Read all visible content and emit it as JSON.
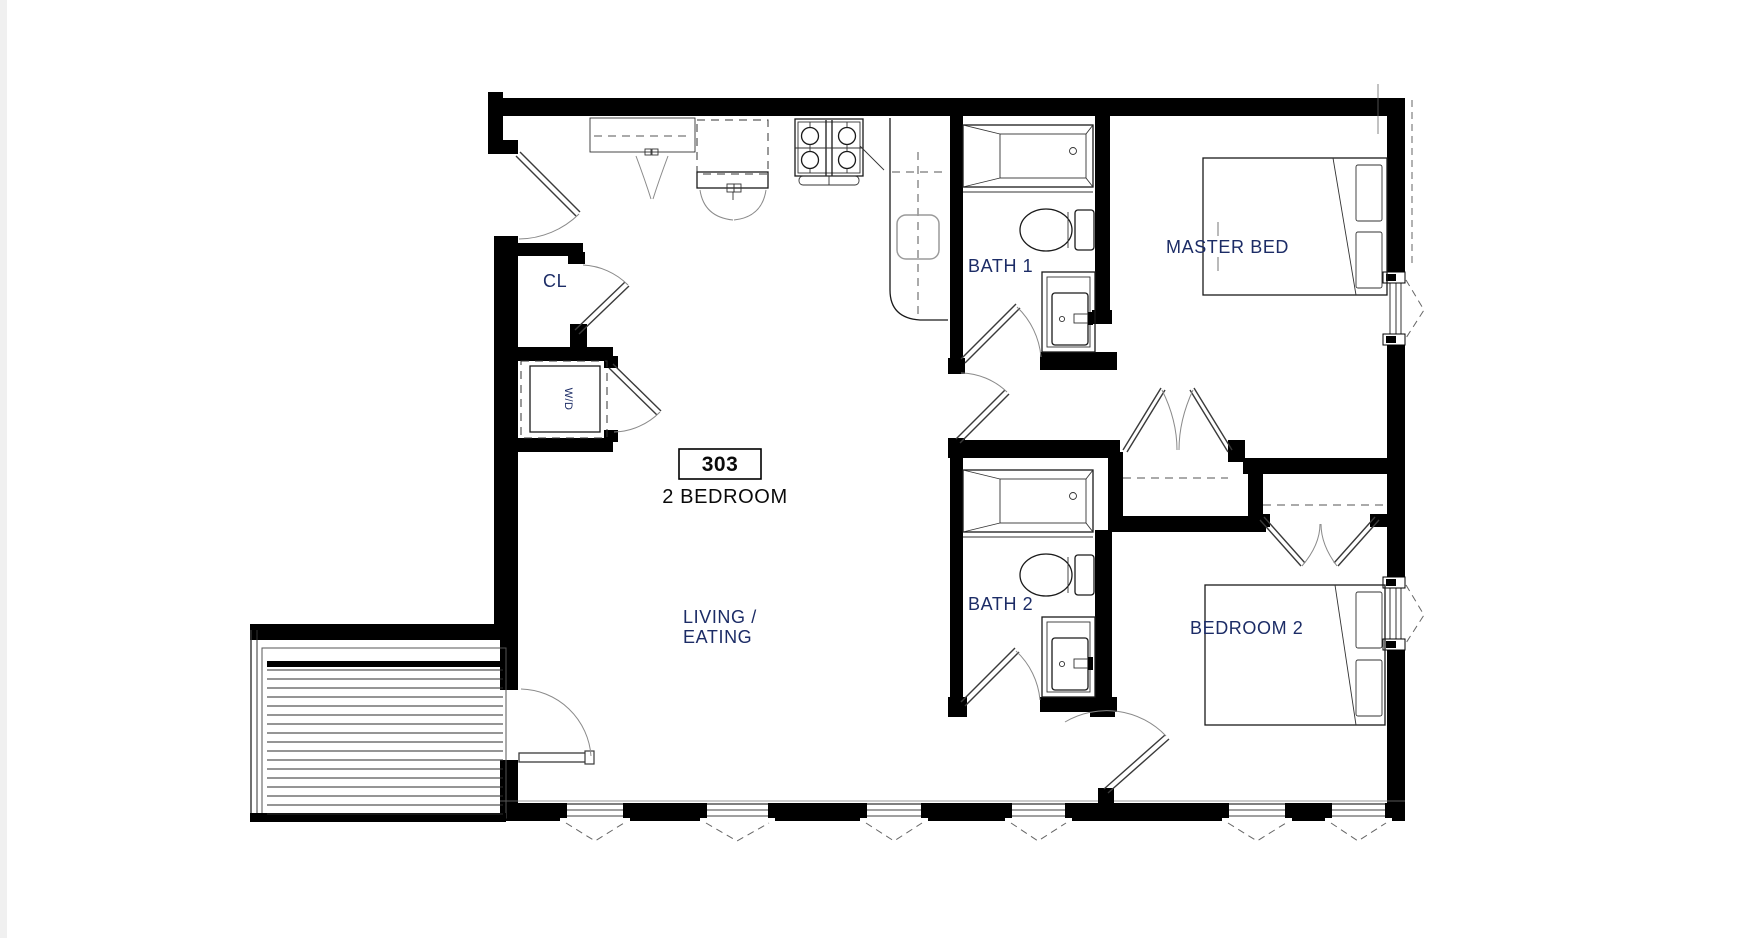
{
  "unit": {
    "number": "303",
    "type": "2 BEDROOM"
  },
  "rooms": {
    "living": {
      "label_line1": "LIVING /",
      "label_line2": "EATING"
    },
    "master": {
      "label": "MASTER BED"
    },
    "bath1": {
      "label": "BATH 1"
    },
    "bath2": {
      "label": "BATH 2"
    },
    "bedroom2": {
      "label": "BEDROOM 2"
    },
    "entry_closet": {
      "label": "CL"
    },
    "laundry": {
      "label": "W/D"
    }
  },
  "colors": {
    "page_bg": "#ffffff",
    "edge_strip": "#f0f0f0",
    "line": "#000000",
    "room_label": "#1c2c66",
    "unit_label": "#0a0a0a"
  }
}
